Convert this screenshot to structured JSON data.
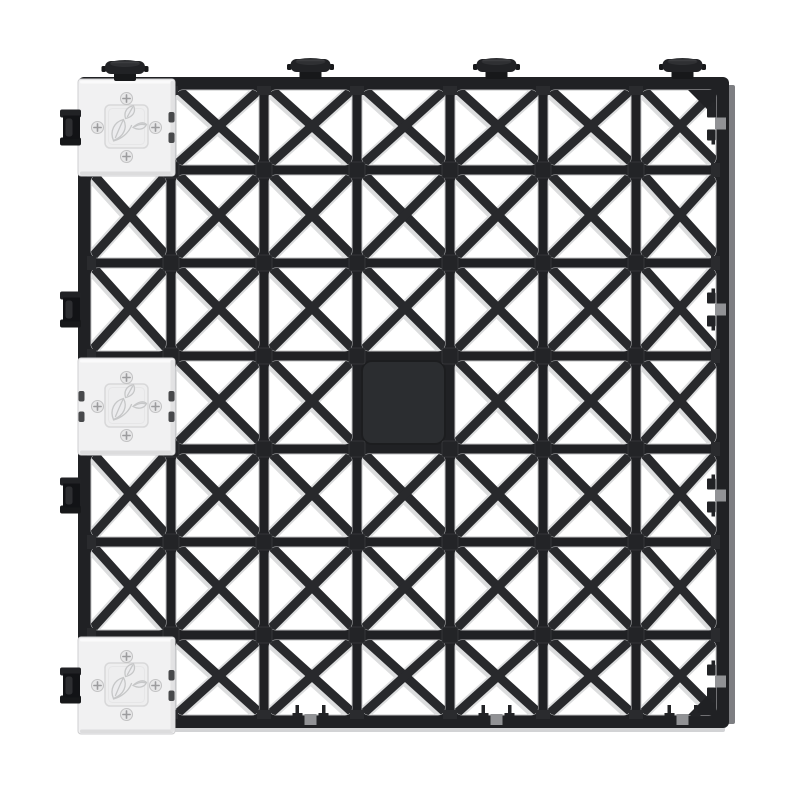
{
  "product": {
    "name": "interlocking-grid-tile-render",
    "background": "#ffffff",
    "grid": {
      "rows": 7,
      "cols": 7,
      "x": 78,
      "y": 77,
      "cell": 93
    },
    "colors": {
      "plastic_dark": "#202124",
      "bar_dark": "#28292c",
      "highlight": "#dcddde",
      "hole_stroke": "#bfc0c2",
      "panel": "#2b2d30",
      "panel_edge": "#1c1d1f",
      "node": "#232427",
      "node_edge": "#3a3b3e",
      "edge_bump": "#2a2b2e",
      "side_face": "#7d7e82",
      "bottom_face": "#d2d3d5",
      "white_tile": "#f1f1f2",
      "white_tile_stroke": "#cfcfd1",
      "white_tile_top": "#fafafb",
      "white_tile_shade": "#dcdcdd",
      "emboss_fill": "#eeeeef",
      "emboss_border": "#d8d8d9",
      "emboss_inner": "#e6e6e7",
      "logo_stroke": "#c6c7c8",
      "logo_fill": "#ececee",
      "screw_fill": "#e7e7e8",
      "screw_rim": "#c3c3c4",
      "screw_cross": "#9c9c9e",
      "slot": "#48494b",
      "knob_cap": "#212225",
      "knob_top": "#2f3033",
      "knob_neck": "#17181a",
      "knob_rim": "#3c3d40",
      "clip_flange": "#212225",
      "clip_body": "#121316",
      "clip_band": "#2d2e31",
      "notch_patch": "#919295",
      "notch_hook": "#222326"
    },
    "filled_cell": {
      "row": 4,
      "col": 4
    },
    "white_tiles": [
      {
        "row": 1,
        "col": 1,
        "knob": true,
        "clip": true,
        "left_slots": false
      },
      {
        "row": 4,
        "col": 1,
        "knob": false,
        "clip": false,
        "left_slots": true
      },
      {
        "row": 7,
        "col": 1,
        "knob": false,
        "clip": true,
        "left_slots": false
      }
    ],
    "top_knob_cols": [
      3,
      5,
      7
    ],
    "left_clip_rows": [
      3,
      5
    ],
    "right_notch_rows": [
      1,
      3,
      5,
      7
    ],
    "bottom_notch_cols": [
      3,
      5,
      7
    ],
    "logo_icon": "leaf-sprout-icon",
    "screw_icon": "phillips-screw-icon"
  }
}
